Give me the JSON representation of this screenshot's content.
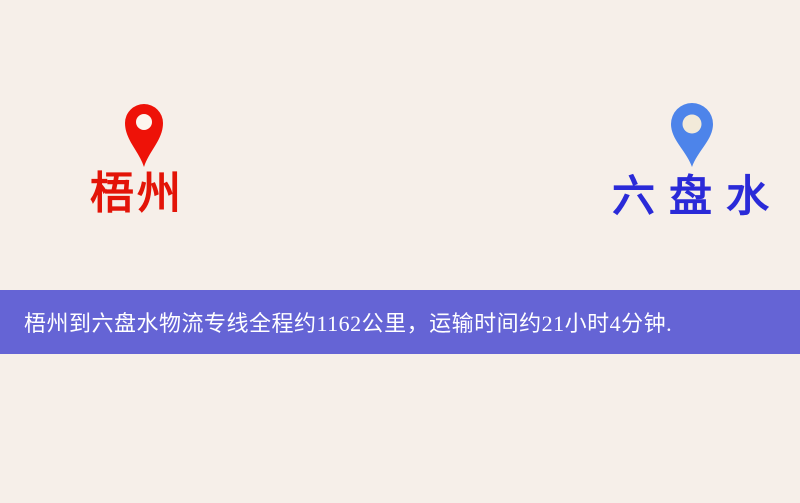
{
  "map": {
    "background_color": "#f6efe9",
    "road_color": "#f7d57c",
    "road_casing_color": "#e7ae57",
    "water_color": "#9cc3e6",
    "park_color": "#dcead0",
    "building_color": "#eee4c8",
    "railway_colors": [
      "#3a3a3a",
      "#ffffff"
    ],
    "origin": {
      "name": "梧州",
      "label_color": "#e31408",
      "pin_color": "#ee1208"
    },
    "destination": {
      "name": "六盘水",
      "label_color": "#2a2ad8",
      "pin_color": "#4d84ea"
    }
  },
  "banner": {
    "text": "梧州到六盘水物流专线全程约1162公里，运输时间约21小时4分钟.",
    "background_color": "#4141d0",
    "text_color": "#ffffff"
  }
}
